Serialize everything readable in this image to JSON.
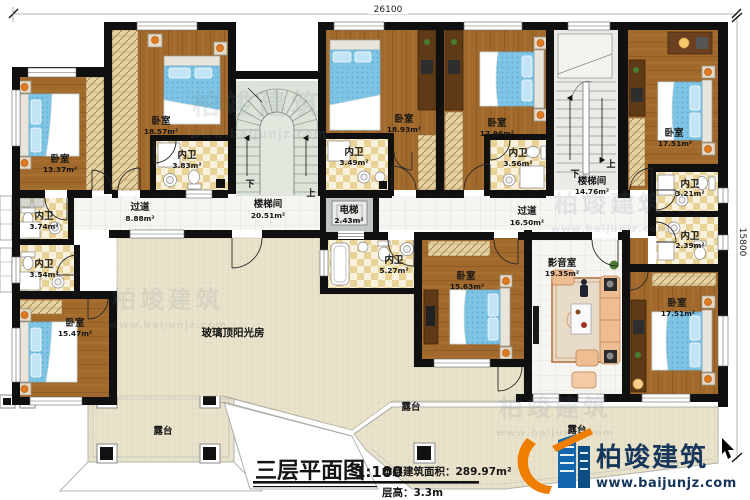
{
  "drawing": {
    "dim_top": "26100",
    "dim_right": "15800",
    "title": "三层平面图",
    "scale": "1:100",
    "stats_area": "本层建筑面积：289.97m²",
    "stats_height": "层高：3.3m"
  },
  "brand": {
    "name": "柏竣建筑",
    "website": "www.baijunjz.com"
  },
  "stairs": {
    "up": "上",
    "down": "下"
  },
  "rooms": {
    "bedroom_tl": {
      "label": "卧室",
      "area": "13.37m²"
    },
    "bedroom_tl2": {
      "label": "卧室",
      "area": "18.57m²"
    },
    "bath_383": {
      "label": "内卫",
      "area": "3.83m²"
    },
    "bath_374": {
      "label": "内卫",
      "area": "3.74m²"
    },
    "bath_354": {
      "label": "内卫",
      "area": "3.54m²"
    },
    "bedroom_bl": {
      "label": "卧室",
      "area": "15.47m²"
    },
    "corridor_left": {
      "label": "过道",
      "area": "8.88m²"
    },
    "stair_left": {
      "label": "楼梯间",
      "area": "20.51m²"
    },
    "elevator": {
      "label": "电梯",
      "area": "2.43m²"
    },
    "bedroom_tc1": {
      "label": "卧室",
      "area": "18.93m²"
    },
    "bath_349": {
      "label": "内卫",
      "area": "3.49m²"
    },
    "bedroom_tc2": {
      "label": "卧室",
      "area": "17.96m²"
    },
    "bath_356": {
      "label": "内卫",
      "area": "3.56m²"
    },
    "corridor_main": {
      "label": "过道",
      "area": "16.50m²"
    },
    "stair_right": {
      "label": "楼梯间",
      "area": "14.76m²"
    },
    "bedroom_tr": {
      "label": "卧室",
      "area": "17.51m²"
    },
    "bath_321": {
      "label": "内卫",
      "area": "3.21m²"
    },
    "bath_239": {
      "label": "内卫",
      "area": "2.39m²"
    },
    "bath_527": {
      "label": "内卫",
      "area": "5.27m²"
    },
    "bedroom_c": {
      "label": "卧室",
      "area": "15.63m²"
    },
    "media_room": {
      "label": "影音室",
      "area": "19.35m²"
    },
    "bedroom_br": {
      "label": "卧室",
      "area": "17.51m²"
    },
    "sunroom": {
      "label": "玻璃顶阳光房"
    },
    "terrace_left": {
      "label": "露台"
    },
    "terrace_mid": {
      "label": "露台"
    },
    "terrace_bottom": {
      "label": "露台"
    }
  }
}
